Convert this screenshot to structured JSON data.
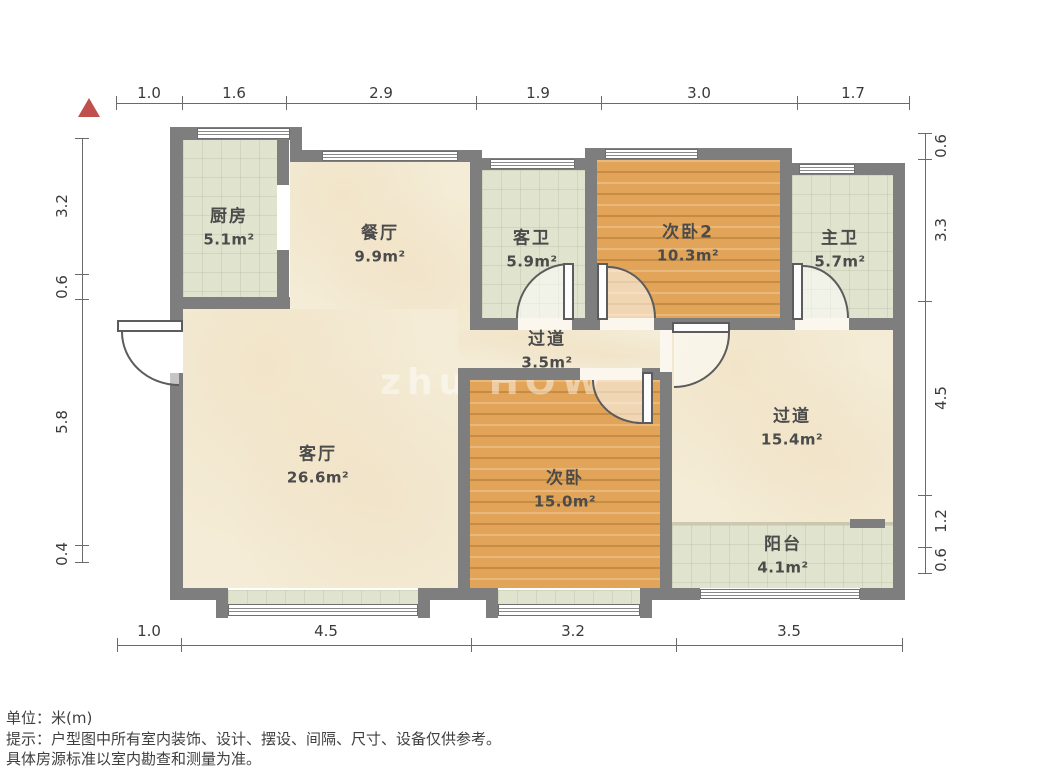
{
  "plan": {
    "type": "floor-plan",
    "north_indicator": "red-triangle-top-left"
  },
  "dims": {
    "top": [
      "1.0",
      "1.6",
      "2.9",
      "1.9",
      "3.0",
      "1.7"
    ],
    "bottom": [
      "1.0",
      "4.5",
      "3.2",
      "3.5"
    ],
    "left": [
      "3.2",
      "0.6",
      "5.8",
      "0.4"
    ],
    "right": [
      "0.6",
      "3.3",
      "4.5",
      "1.2",
      "0.6"
    ]
  },
  "rooms": [
    {
      "id": "kitchen",
      "name": "厨房",
      "area": "5.1m²"
    },
    {
      "id": "dining",
      "name": "餐厅",
      "area": "9.9m²"
    },
    {
      "id": "guest-bath",
      "name": "客卫",
      "area": "5.9m²"
    },
    {
      "id": "bedroom-2",
      "name": "次卧2",
      "area": "10.3m²"
    },
    {
      "id": "master-bath",
      "name": "主卫",
      "area": "5.7m²"
    },
    {
      "id": "hallway-small",
      "name": "过道",
      "area": "3.5m²"
    },
    {
      "id": "living-room",
      "name": "客厅",
      "area": "26.6m²"
    },
    {
      "id": "bedroom",
      "name": "次卧",
      "area": "15.0m²"
    },
    {
      "id": "hallway-large",
      "name": "过道",
      "area": "15.4m²"
    },
    {
      "id": "balcony",
      "name": "阳台",
      "area": "4.1m²"
    }
  ],
  "watermark": "zhu HOW",
  "footer": {
    "unit": "单位：米(m)",
    "tip": "提示：户型图中所有室内装饰、设计、摆设、间隔、尺寸、设备仅供参考。",
    "tip2": "具体房源标准以室内勘查和测量为准。"
  },
  "colors": {
    "wall": "#7e7e7e",
    "wood_floor": "#e1a458",
    "tile_floor": "#e0e4ce",
    "main_floor": "#f4ecd6",
    "north_arrow": "#c0504d"
  }
}
